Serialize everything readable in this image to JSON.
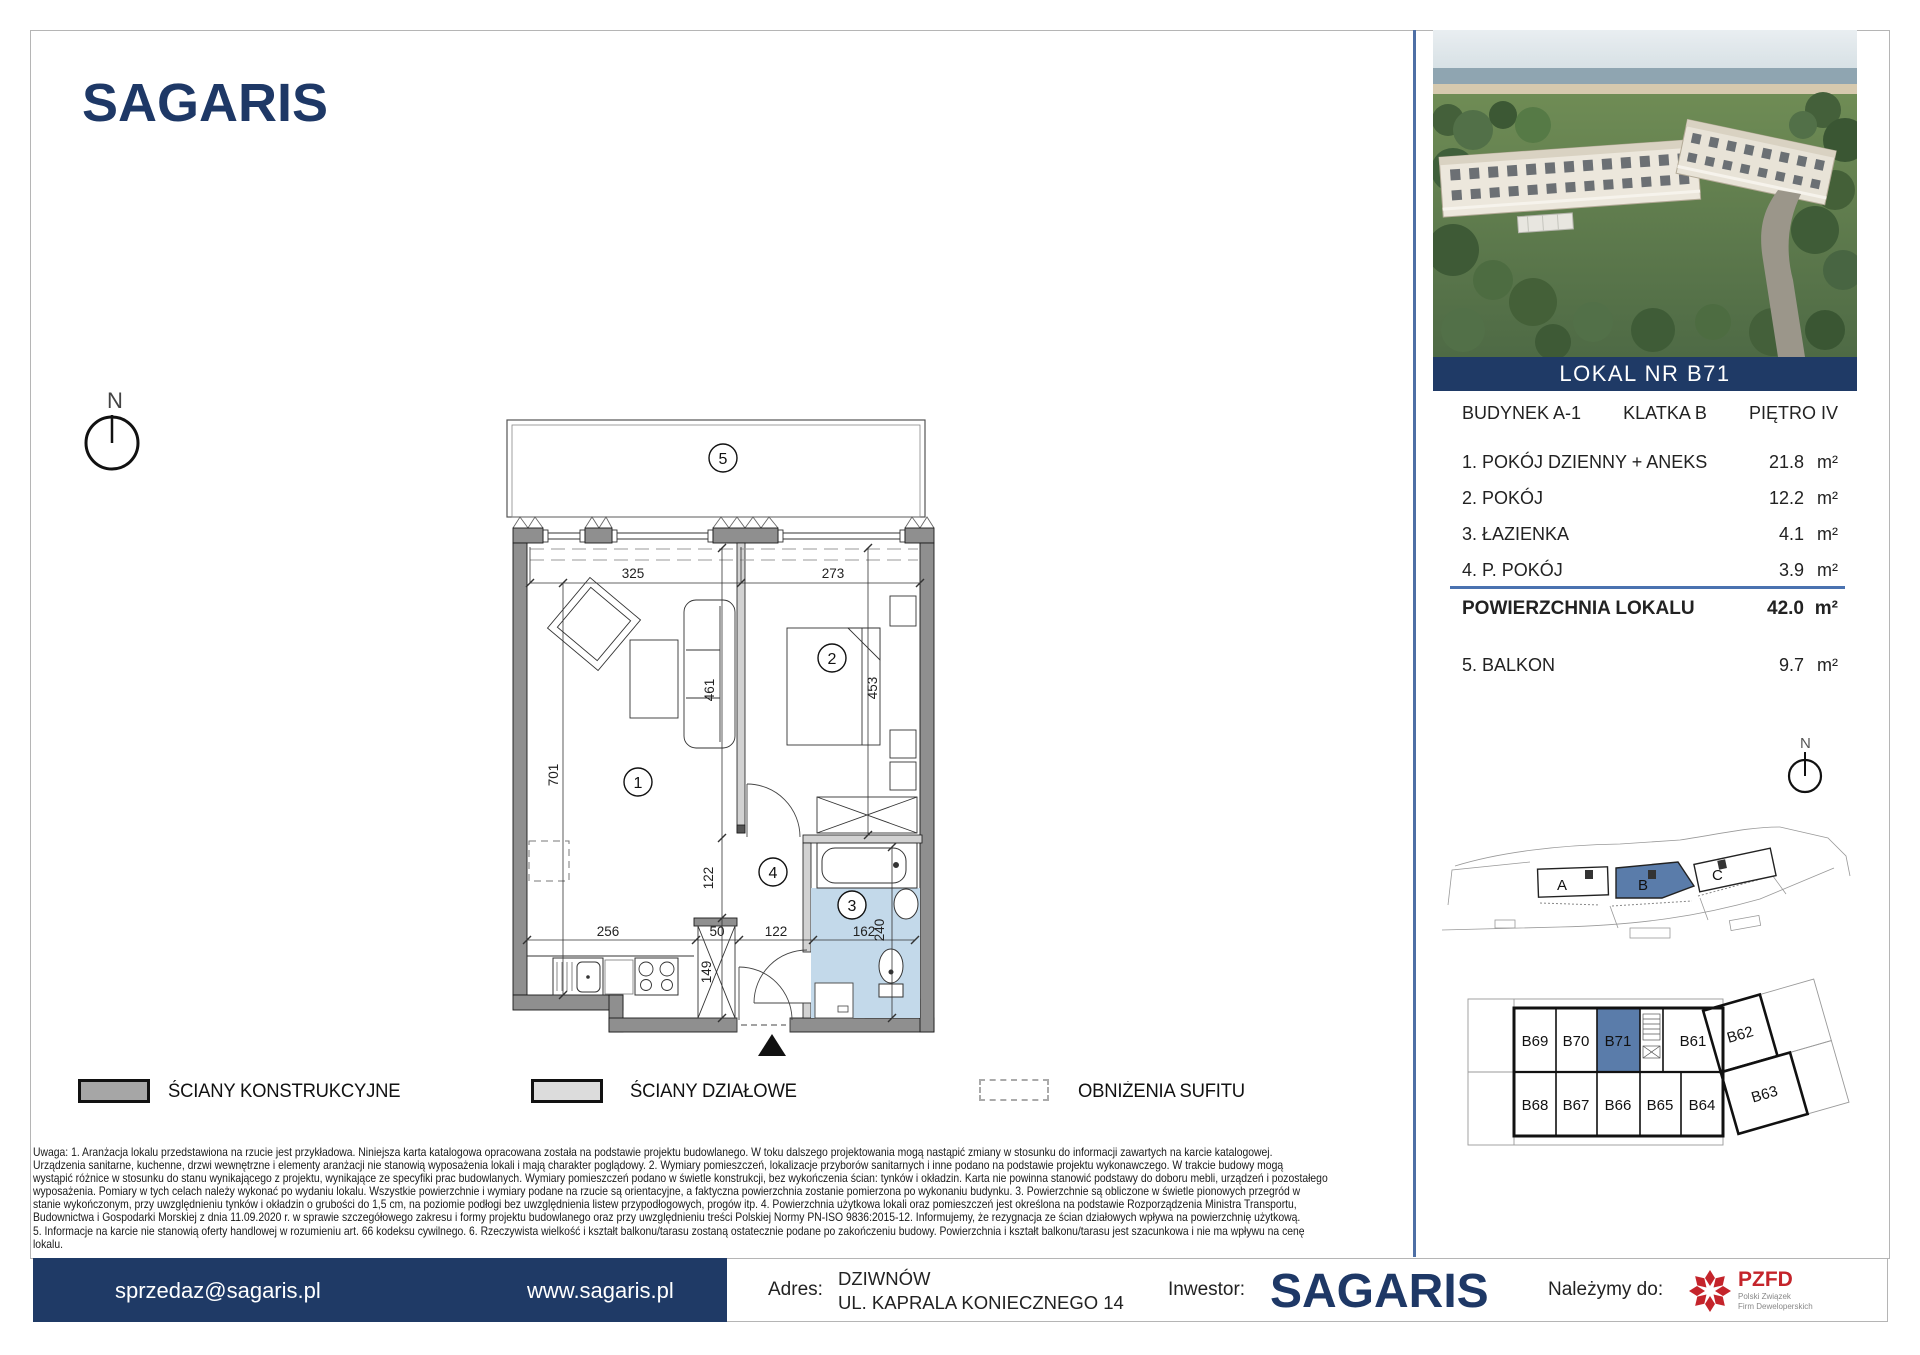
{
  "brand": {
    "name": "SAGARIS"
  },
  "panel": {
    "banner": "LOKAL NR B71",
    "building": "BUDYNEK A-1",
    "staircase": "KLATKA B",
    "floor": "PIĘTRO IV",
    "rooms": [
      {
        "name": "1. POKÓJ DZIENNY + ANEKS",
        "area": "21.8",
        "unit": "m²"
      },
      {
        "name": "2. POKÓJ",
        "area": "12.2",
        "unit": "m²"
      },
      {
        "name": "3. ŁAZIENKA",
        "area": "4.1",
        "unit": "m²"
      },
      {
        "name": "4. P. POKÓJ",
        "area": "3.9",
        "unit": "m²"
      }
    ],
    "total": {
      "label": "POWIERZCHNIA LOKALU",
      "area": "42.0",
      "unit": "m²"
    },
    "balcony": {
      "name": "5. BALKON",
      "area": "9.7",
      "unit": "m²"
    },
    "compass": "N"
  },
  "plan": {
    "compass": "N",
    "numbers": {
      "r1": "1",
      "r2": "2",
      "r3": "3",
      "r4": "4",
      "r5": "5"
    },
    "dims": {
      "w1": "325",
      "w2": "273",
      "h1": "701",
      "s1": "461",
      "s2": "453",
      "b1": "256",
      "b2": "50",
      "b3": "122",
      "b4": "162",
      "v1": "122",
      "v2": "149",
      "v3": "240"
    }
  },
  "legend": {
    "items": [
      {
        "label": "ŚCIANY KONSTRUKCYJNE"
      },
      {
        "label": "ŚCIANY DZIAŁOWE"
      },
      {
        "label": "OBNIŻENIA SUFITU"
      }
    ]
  },
  "site_map": {
    "a": "A",
    "b": "B",
    "c": "C"
  },
  "floor_map": {
    "top": [
      "B69",
      "B70",
      "B71",
      "B61",
      "B62"
    ],
    "bottom": [
      "B68",
      "B67",
      "B66",
      "B65",
      "B64",
      "B63"
    ]
  },
  "disclaimer": {
    "lines": [
      "Uwaga:    1. Aranżacja lokalu przedstawiona na rzucie jest przykładowa. Niniejsza karta katalogowa opracowana została na podstawie projektu budowlanego. W toku dalszego projektowania mogą nastąpić zmiany w stosunku do informacji zawartych na karcie katalogowej.",
      "Urządzenia sanitarne, kuchenne, drzwi wewnętrzne i elementy aranżacji nie stanowią wyposażenia lokali i mają charakter poglądowy.    2. Wymiary pomieszczeń, lokalizacje przyborów sanitarnych i inne podano na podstawie projektu wykonawczego. W trakcie budowy mogą",
      "wystąpić różnice w stosunku do stanu wynikającego z projektu, wynikające ze specyfiki prac budowlanych. Wymiary pomieszczeń podano w świetle konstrukcji, bez wykończenia ścian: tynków i okładzin. Karta nie powinna stanowić podstawy do doboru mebli, urządzeń i pozostałego",
      "wyposażenia. Pomiary w tych celach należy wykonać po wydaniu lokalu. Wszystkie powierzchnie i wymiary podane na rzucie są orientacyjne, a faktyczna powierzchnia zostanie pomierzona po wykonaniu budynku.    3. Powierzchnie są obliczone w świetle pionowych przegród w",
      "stanie wykończonym, przy uwzględnieniu tynków i okładzin o grubości do 1,5 cm, na poziomie podłogi bez uwzględnienia listew przypodłogowych, progów itp.    4. Powierzchnia użytkowa lokali oraz pomieszczeń jest określona na podstawie Rozporządzenia Ministra Transportu,",
      "Budownictwa i Gospodarki Morskiej z dnia 11.09.2020 r. w sprawie szczegółowego zakresu i formy projektu budowlanego oraz przy uwzględnieniu treści Polskiej Normy PN-ISO 9836:2015-12. Informujemy, że rezygnacja ze ścian działowych wpływa na powierzchnię użytkową.",
      "5. Informacje na karcie nie stanowią oferty handlowej w rozumieniu art. 66 kodeksu cywilnego.    6. Rzeczywista wielkość i kształt balkonu/tarasu zostaną ostatecznie podane po zakończeniu budowy. Powierzchnia i kształt balkonu/tarasu jest szacunkowa i nie ma wpływu na cenę",
      "lokalu."
    ]
  },
  "footer": {
    "email": "sprzedaz@sagaris.pl",
    "website": "www.sagaris.pl",
    "address_label": "Adres:",
    "address_line1": "DZIWNÓW",
    "address_line2": "UL. KAPRALA KONIECZNEGO 14",
    "investor_label": "Inwestor:",
    "investor_name": "SAGARIS",
    "member_label": "Należymy do:",
    "pzfd": {
      "abbr": "PZFD",
      "line1": "Polski Związek",
      "line2": "Firm Deweloperskich"
    }
  },
  "colors": {
    "navy": "#1f3a66",
    "accent_blue": "#4e6fa5",
    "highlight": "#5a7caa",
    "bath_floor": "#c3d9ea"
  }
}
